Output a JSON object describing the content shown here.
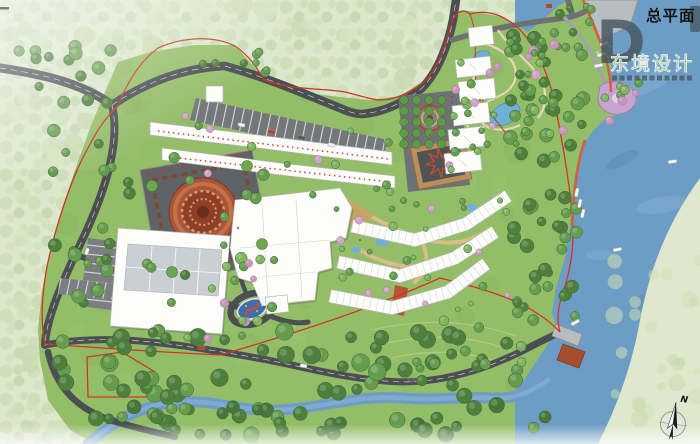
{
  "title": {
    "text": "总平面"
  },
  "watermark": {
    "logo": "D",
    "name": "东境设计"
  },
  "compass": {
    "label": "N"
  },
  "counts": {
    "boats": 9,
    "cars": 8
  },
  "palette": {
    "water": "#6d9dc5",
    "water_light": "#84aed2",
    "water_deep": "#5d8db6",
    "site_green": "#94bd68",
    "lawn": "#a8cc79",
    "pale_forest": "#dce7cb",
    "forest_dark": "#4e7f3d",
    "road": "#4b4f52",
    "building": "#fdfdfc",
    "boundary_red": "#d03527",
    "revetment_orange": "#d2603a",
    "plaza_terracotta": "#a85539",
    "plaza_gray": "#5f6366",
    "sandbank": "#dfe8cc",
    "blossom_pink": "#c795bc",
    "lookout_purple": "#c9a3cf",
    "courtyard_tan": "#b98f5c",
    "roundabout_blue": "#3f6db0"
  },
  "features": [
    "plan-title",
    "design-watermark",
    "north-compass",
    "lake",
    "river",
    "sandbank",
    "marina-dock",
    "boats",
    "pier",
    "pier-pavilion",
    "mandala-plaza",
    "conference-center",
    "retail-street",
    "shopping-mall",
    "residential-rows",
    "point-towers",
    "fountain-plaza",
    "star-courtyard",
    "roundabout-artwork",
    "hillside-garden",
    "ponds",
    "lookout-plaza",
    "parking-lots",
    "site-boundary",
    "detached-parcel",
    "road-network",
    "forest"
  ]
}
